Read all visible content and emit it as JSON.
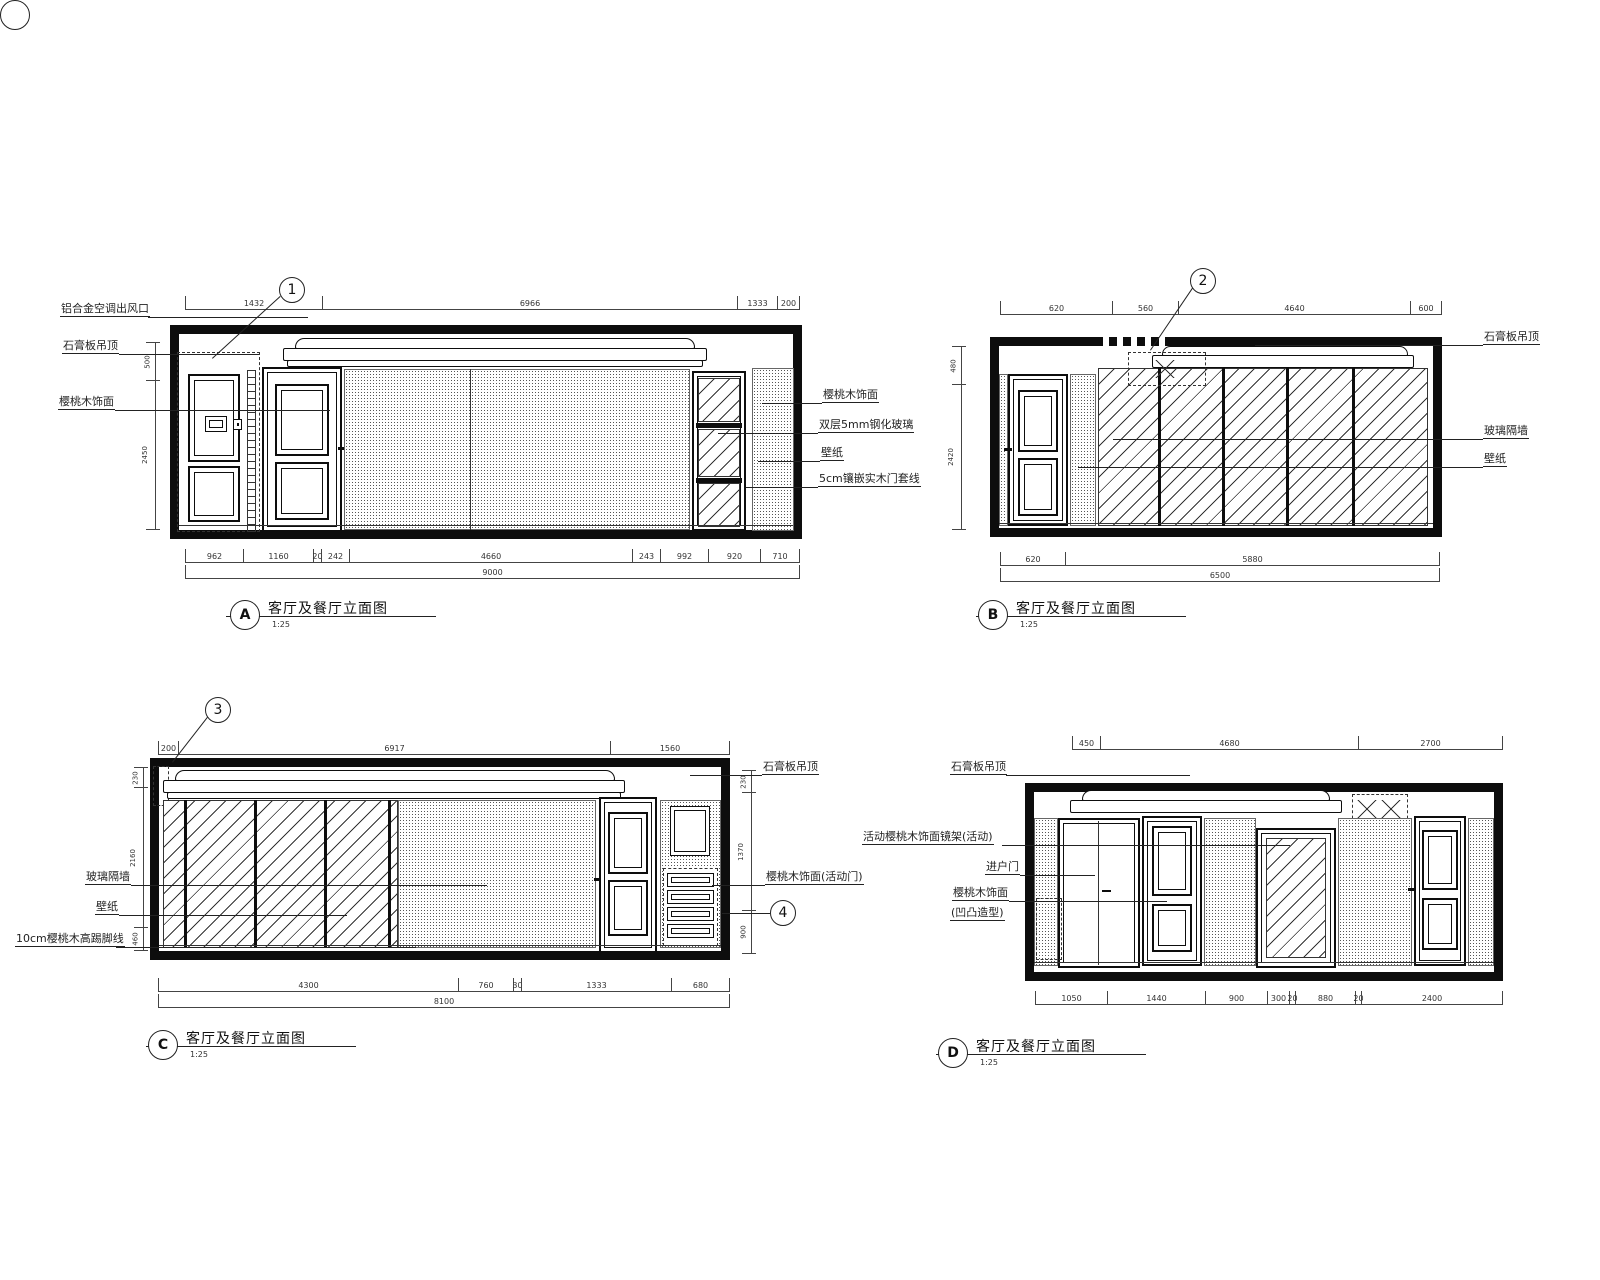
{
  "page": {
    "background": "#ffffff",
    "ink": "#111111"
  },
  "drawings": {
    "a": {
      "callout": "1",
      "title_letter": "A",
      "title": "客厅及餐厅立面图",
      "scale": "1:25",
      "labels_left": [
        "铝合金空调出风口",
        "石膏板吊顶",
        "樱桃木饰面"
      ],
      "labels_right": [
        "樱桃木饰面",
        "双层5mm钢化玻璃",
        "壁纸",
        "5cm镶嵌实木门套线"
      ],
      "dims_top": [
        "1432",
        "6966",
        "1333",
        "200"
      ],
      "dims_bottom": [
        "962",
        "1160",
        "20",
        "242",
        "4660",
        "243",
        "992",
        "920",
        "710"
      ],
      "dim_total": "9000",
      "dims_left": [
        "500",
        "2450"
      ]
    },
    "b": {
      "callout": "2",
      "title_letter": "B",
      "title": "客厅及餐厅立面图",
      "scale": "1:25",
      "labels_right": [
        "石膏板吊顶",
        "玻璃隔墙",
        "壁纸"
      ],
      "dims_top": [
        "620",
        "560",
        "4640",
        "600"
      ],
      "dims_bottom": [
        "620",
        "5880"
      ],
      "dim_total": "6500",
      "dims_left": [
        "480",
        "2420"
      ]
    },
    "c": {
      "callout": "3",
      "callout2": "4",
      "title_letter": "C",
      "title": "客厅及餐厅立面图",
      "scale": "1:25",
      "labels_left": [
        "玻璃隔墙",
        "壁纸",
        "10cm樱桃木高踢脚线"
      ],
      "labels_right": [
        "石膏板吊顶",
        "樱桃木饰面(活动门)"
      ],
      "dims_top": [
        "200",
        "6917",
        "1560"
      ],
      "dims_bottom": [
        "4300",
        "760",
        "30",
        "1333",
        "680"
      ],
      "dim_total": "8100",
      "dims_left": [
        "230",
        "2160",
        "460"
      ],
      "dims_right": [
        "230",
        "1370",
        "900"
      ]
    },
    "d": {
      "title_letter": "D",
      "title": "客厅及餐厅立面图",
      "scale": "1:25",
      "labels_left": [
        "石膏板吊顶",
        "活动樱桃木饰面镜架(活动)",
        "进户门",
        "樱桃木饰面",
        "(凹凸造型)"
      ],
      "dims_top": [
        "450",
        "4680",
        "2700"
      ],
      "dims_bottom": [
        "1050",
        "1440",
        "900",
        "300",
        "20",
        "880",
        "20",
        "2400"
      ]
    }
  }
}
